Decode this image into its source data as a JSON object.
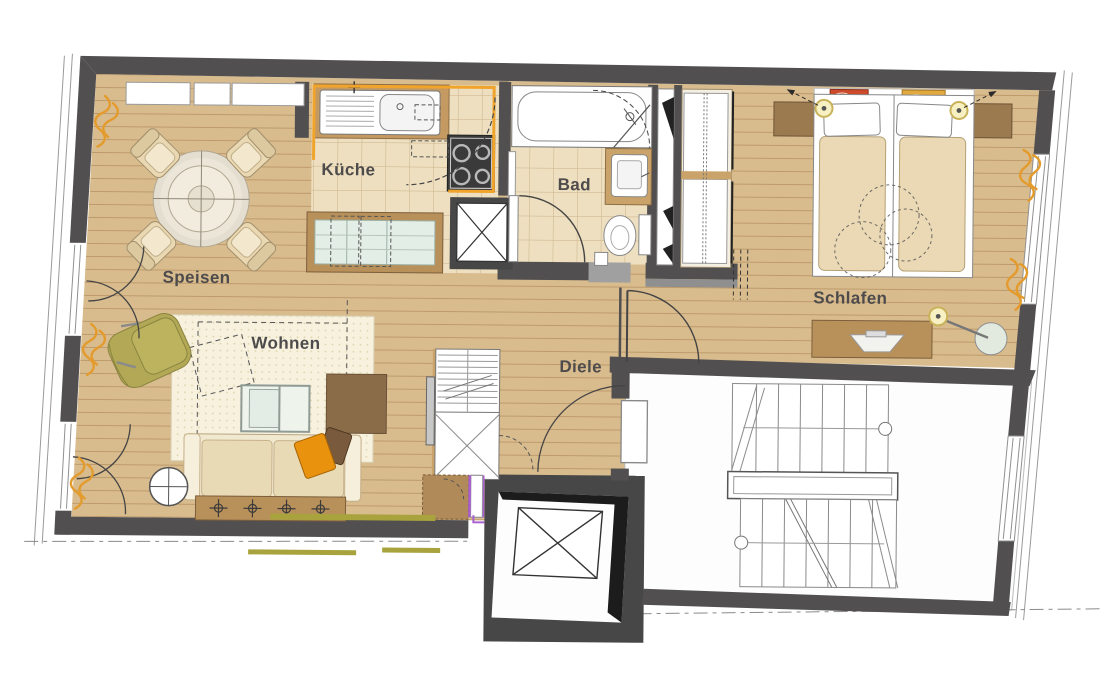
{
  "plan_type": "apartment-floor-plan",
  "rooms": [
    {
      "id": "speisen",
      "label": "Speisen"
    },
    {
      "id": "kueche",
      "label": "Küche"
    },
    {
      "id": "bad",
      "label": "Bad"
    },
    {
      "id": "schlafen",
      "label": "Schlafen"
    },
    {
      "id": "wohnen",
      "label": "Wohnen"
    },
    {
      "id": "diele",
      "label": "Diele"
    }
  ],
  "palette": {
    "wall": "#514f4f",
    "wood_floor": "#d9bc8e",
    "wood_plank_line": "#bd9a6b",
    "tile_floor": "#eddfbf",
    "tile_grout": "#cbb28a",
    "rug": "#f7f1de",
    "kitchen_accent_orange": "#f0a42c",
    "curtain_orange": "#e39b2d",
    "entry_accent_purple": "#a85fd0",
    "olive_strip": "#a8a33c",
    "armchair_olive": "#b2a855",
    "pillow_orange": "#e8920e",
    "furniture_brown": "#8a6c49",
    "counter_brown": "#b8905a",
    "nightstand_brown": "#9b7a4f",
    "label_text": "#4d4b4b"
  },
  "symbols": [
    "dining-table",
    "dining-chair",
    "kitchen-sink",
    "stove",
    "kitchen-island",
    "installation-shaft",
    "bathtub",
    "washbasin",
    "toilet",
    "wardrobe",
    "double-bed",
    "nightstand",
    "bedside-lamp",
    "desk",
    "desk-chair",
    "sofa",
    "armchair",
    "coffee-table",
    "side-table",
    "rug",
    "door-swing",
    "window",
    "curtain-symbol",
    "staircase",
    "elevator"
  ]
}
